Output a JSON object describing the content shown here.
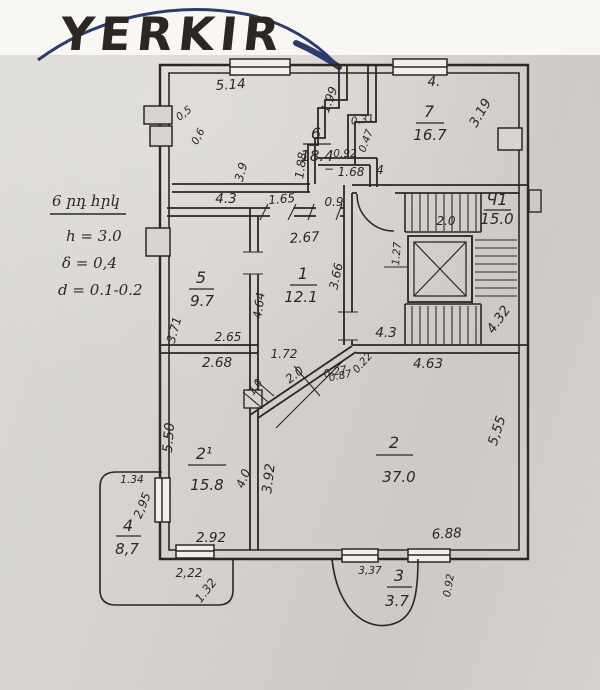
{
  "logo": {
    "text": "YERKIR",
    "color": "#2e3b6e"
  },
  "notes": {
    "title": "6 րդ հրկ",
    "h": "h = 3.0",
    "delta": "δ = 0,4",
    "d": "d = 0.1-0.2"
  },
  "rooms": {
    "r6": {
      "no": "6",
      "area": "18.4"
    },
    "r7": {
      "no": "7",
      "area": "16.7"
    },
    "r5": {
      "no": "5",
      "area": "9.7"
    },
    "r1": {
      "no": "1",
      "area": "12.1"
    },
    "r2p": {
      "no": "2¹",
      "area": "15.8"
    },
    "r2": {
      "no": "2",
      "area": "37.0"
    },
    "r4": {
      "no": "4",
      "area": "8,7"
    },
    "r3": {
      "no": "3",
      "area": "3.7"
    },
    "stair": {
      "no": "Ч1",
      "area": "15.0"
    }
  },
  "dims": {
    "top6": "5.14",
    "diag199": "1.99",
    "top7": "4.",
    "diag319": "3.19",
    "n05": "0,5",
    "n06": "0,6",
    "v39": "3.9",
    "v031": "0.31",
    "v047": "0.47",
    "v092": "0.92",
    "minus": "−",
    "v168": "1.68",
    "v4": "4",
    "v188": "1.88",
    "c43": "4.3",
    "c165": "1.65",
    "c09": "0.9",
    "c267": "2.67",
    "c366": "3.66",
    "c464": "4.64",
    "r5_371": "3.71",
    "r5_265": "2.65",
    "s127": "1.27",
    "s20": "2.0",
    "s432": "4.32",
    "s43": "4.3",
    "s463": "4.63",
    "d022": "0.22",
    "d027": "0.27",
    "d172": "1.72",
    "d20": "2.0",
    "d087": "0.87",
    "d10": "1.0",
    "p268": "2.68",
    "p550": "5.50",
    "p134": "1.34",
    "p295": "2,95",
    "p40": "4.0",
    "p392": "3.92",
    "p292": "2.92",
    "b222": "2,22",
    "b132": "1.32",
    "r2_688": "6.88",
    "r2_555": "5,55",
    "b337": "3,37",
    "b092": "0.92"
  },
  "colors": {
    "paper": "#d8d5d1",
    "ink": "#2b2823",
    "navy": "#2e3b6e"
  }
}
